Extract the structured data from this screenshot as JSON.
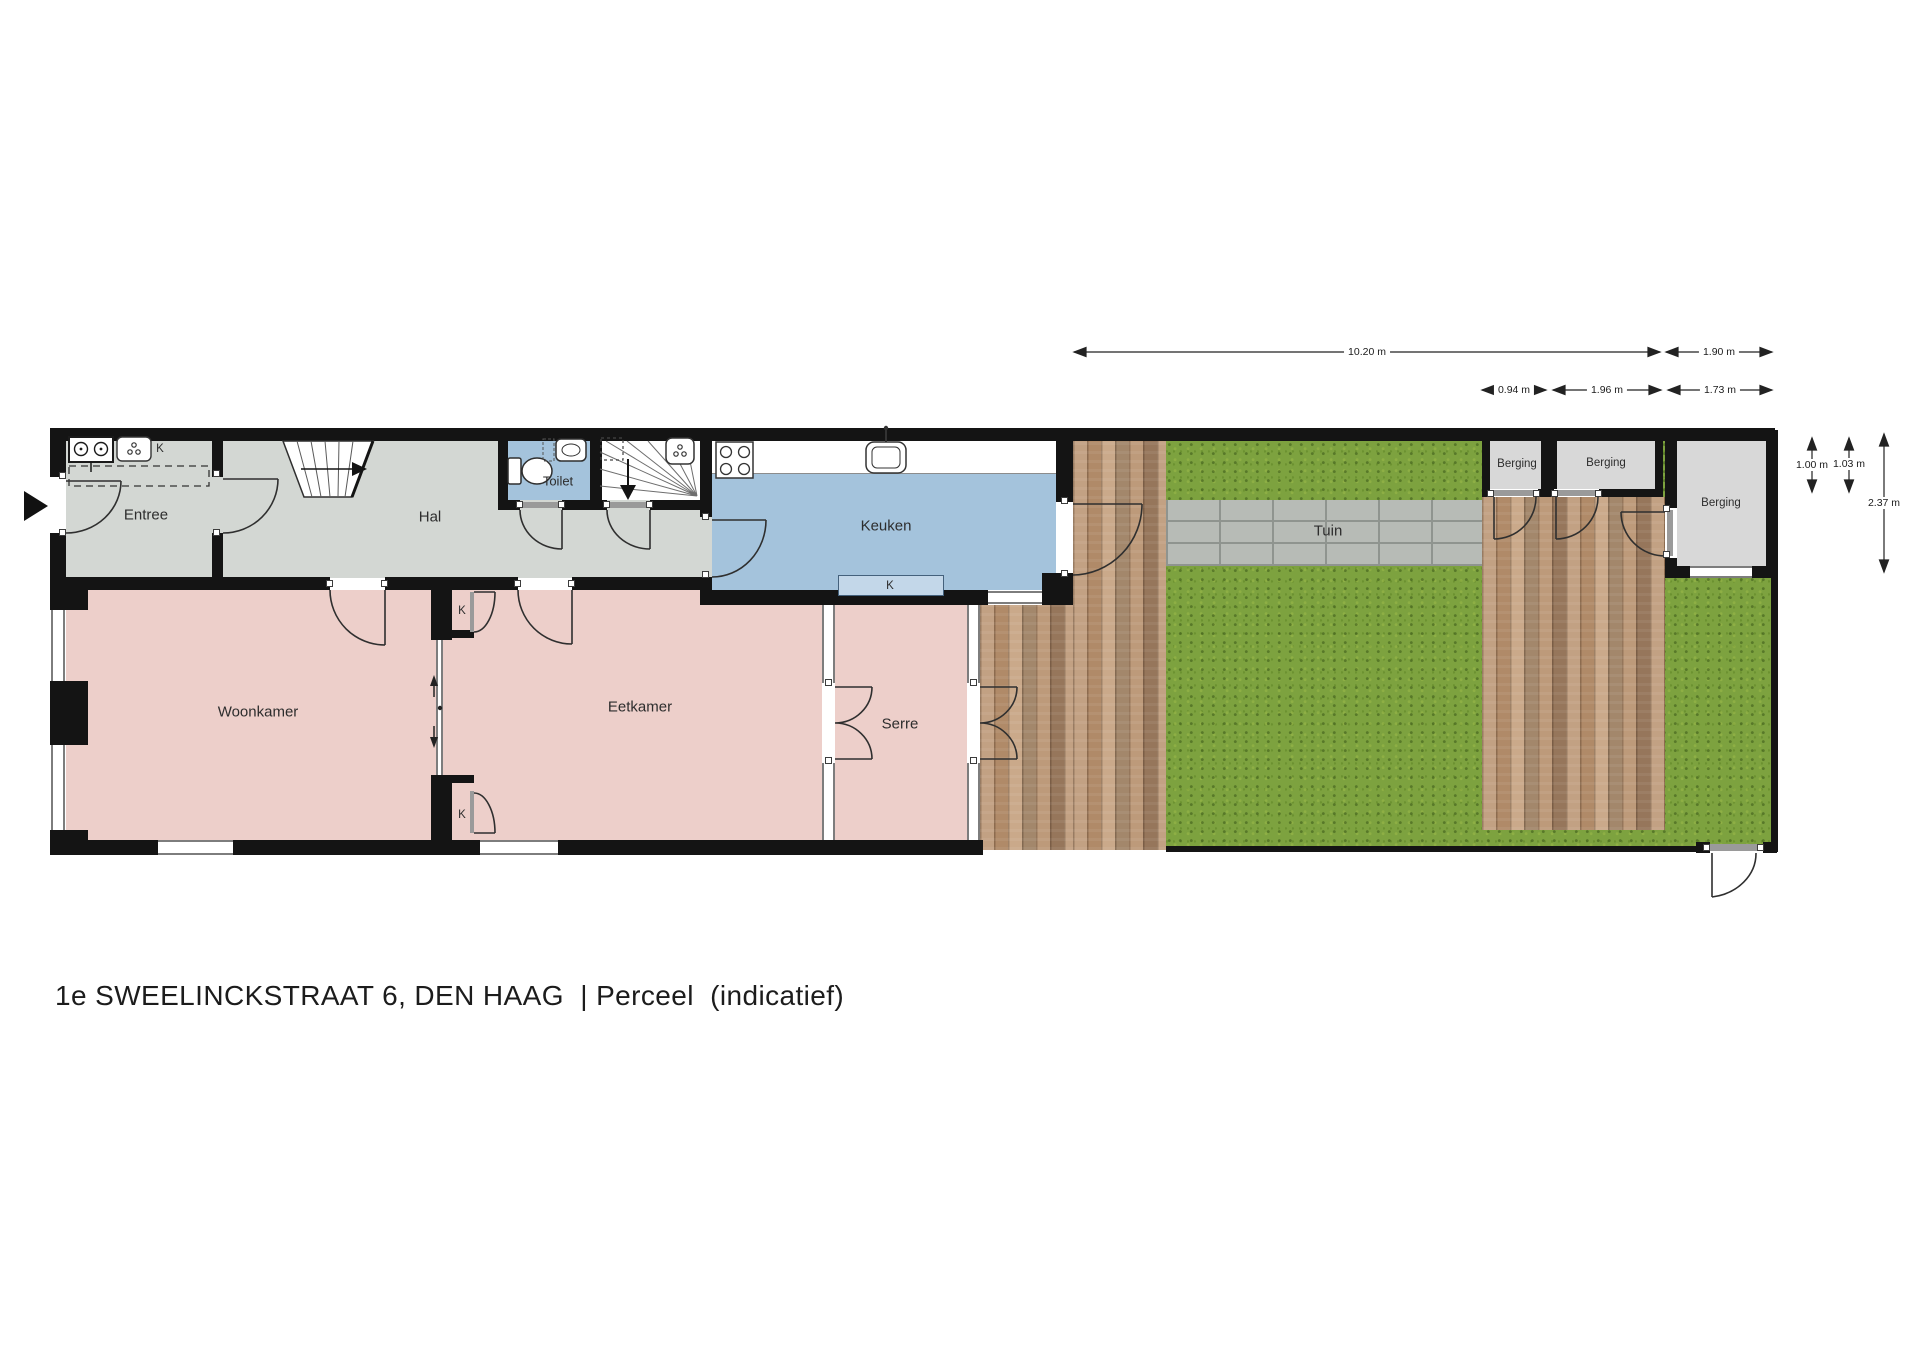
{
  "title": "1e SWEELINCKSTRAAT 6, DEN HAAG  | Perceel  (indicatief)",
  "rooms": {
    "entree": "Entree",
    "hal": "Hal",
    "toilet": "Toilet",
    "keuken": "Keuken",
    "woonkamer": "Woonkamer",
    "eetkamer": "Eetkamer",
    "serre": "Serre",
    "tuin": "Tuin",
    "berging_1": "Berging",
    "berging_2": "Berging",
    "berging_3": "Berging"
  },
  "closet_labels": {
    "meterkast": "K",
    "keuken_kast": "K",
    "kast_boven": "K",
    "kast_onder": "K"
  },
  "dimensions": {
    "garden_length": "10.20 m",
    "berging3_width": "1.90 m",
    "berging1_width": "0.94 m",
    "berging2_width": "1.96 m",
    "berging3_inner_width": "1.73 m",
    "berging1_depth": "1.00 m",
    "berging2_depth": "1.03 m",
    "berging3_depth": "2.37 m"
  },
  "colors": {
    "wall": "#141414",
    "hall_floor": "#d3d7d3",
    "living_floor": "#edcfca",
    "kitchen_floor": "#a4c3dc",
    "berging_floor": "#d8d8d8",
    "grass": "#7da23f",
    "deck_wood": "#b08a68",
    "path_pavers": "#b7bbb6"
  }
}
